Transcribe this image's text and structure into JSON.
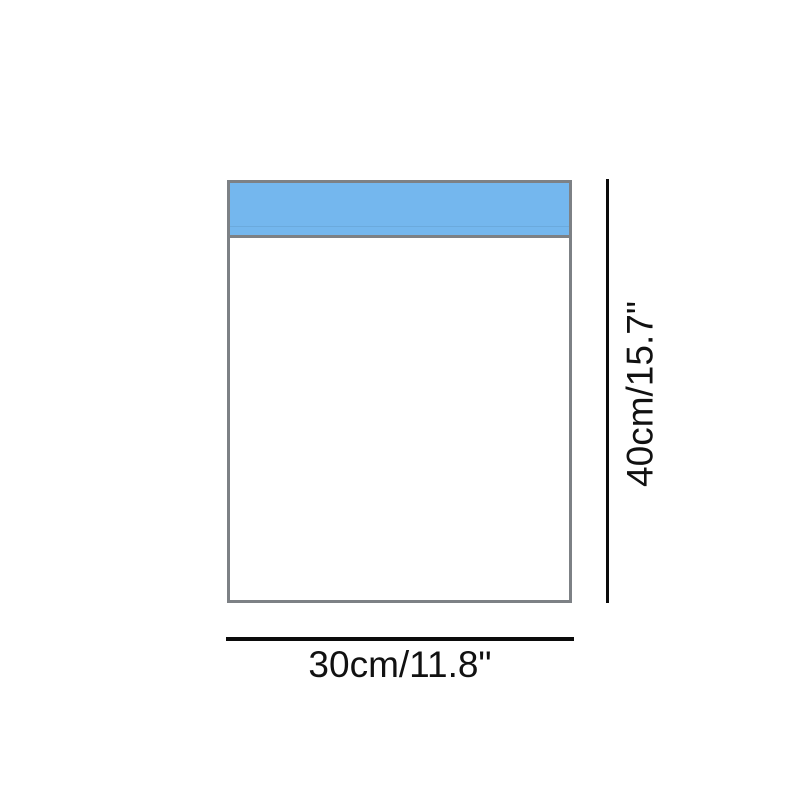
{
  "diagram": {
    "labels": {
      "height": "40cm/15.7\"",
      "width": "30cm/11.8\""
    },
    "colors": {
      "background": "#ffffff",
      "flap_fill": "#74b7ee",
      "outline": "#7d8185",
      "dimension_line": "#0b0b0b",
      "label_text": "#111111"
    }
  }
}
